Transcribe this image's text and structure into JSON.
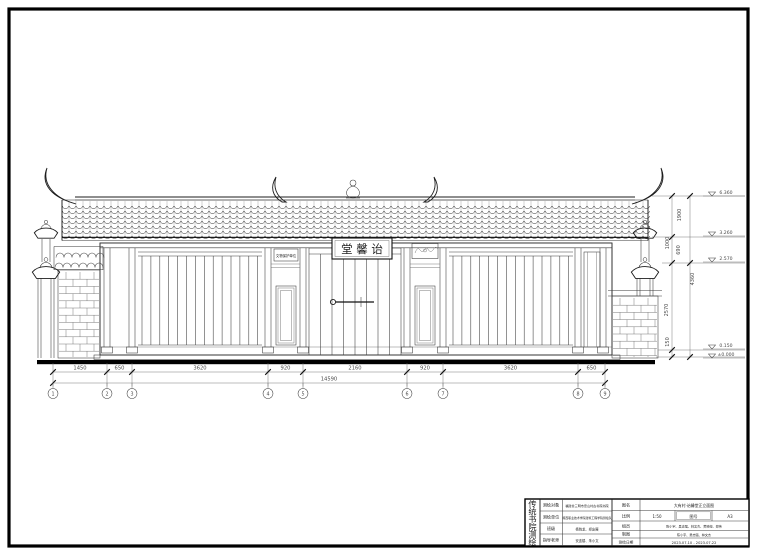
{
  "drawing": {
    "plaque_text": "堂 馨 诒",
    "side_sign_text": "文物保护单位"
  },
  "axes": [
    "1",
    "2",
    "3",
    "4",
    "5",
    "6",
    "7",
    "8",
    "9"
  ],
  "dimensions": {
    "bottom_segments": [
      "1450",
      "650",
      "3620",
      "920",
      "2160",
      "920",
      "3620",
      "650"
    ],
    "bottom_total": "14590",
    "right_labels": [
      "1900",
      "1000",
      "690",
      "4360",
      "2570",
      "150"
    ]
  },
  "elevations": [
    "6.360",
    "3.260",
    "2.570",
    "0.150",
    "±0.000"
  ],
  "title_block": {
    "org_vertical": "传统书院测绘",
    "rows_left": [
      {
        "label": "测绘对象",
        "value": "福建省三明市忠山村古书院书院"
      },
      {
        "label": "测绘单位",
        "value": "闽西职业技术学院建筑工程学院测绘队"
      },
      {
        "label": "班级",
        "value": "杨晓龙、郑友展"
      },
      {
        "label": "指导老师",
        "value": "安连楼、朱小文"
      }
    ],
    "drawing_name_label": "图名",
    "drawing_name": "大有村·诒馨堂正立面图",
    "scale_label": "比例",
    "scale_value": "1:50",
    "sheet_label": "图号",
    "sheet_value": "A3",
    "team_label": "组员",
    "team_value": "陈小宇、吴志强、林文杰、黄晓婷、郑伟",
    "draft_label": "制图",
    "draft_value": "陈小宇、吴志强、林文杰",
    "date_label": "测绘日期",
    "date_value": "2023.07.10 - 2023.07.22"
  }
}
